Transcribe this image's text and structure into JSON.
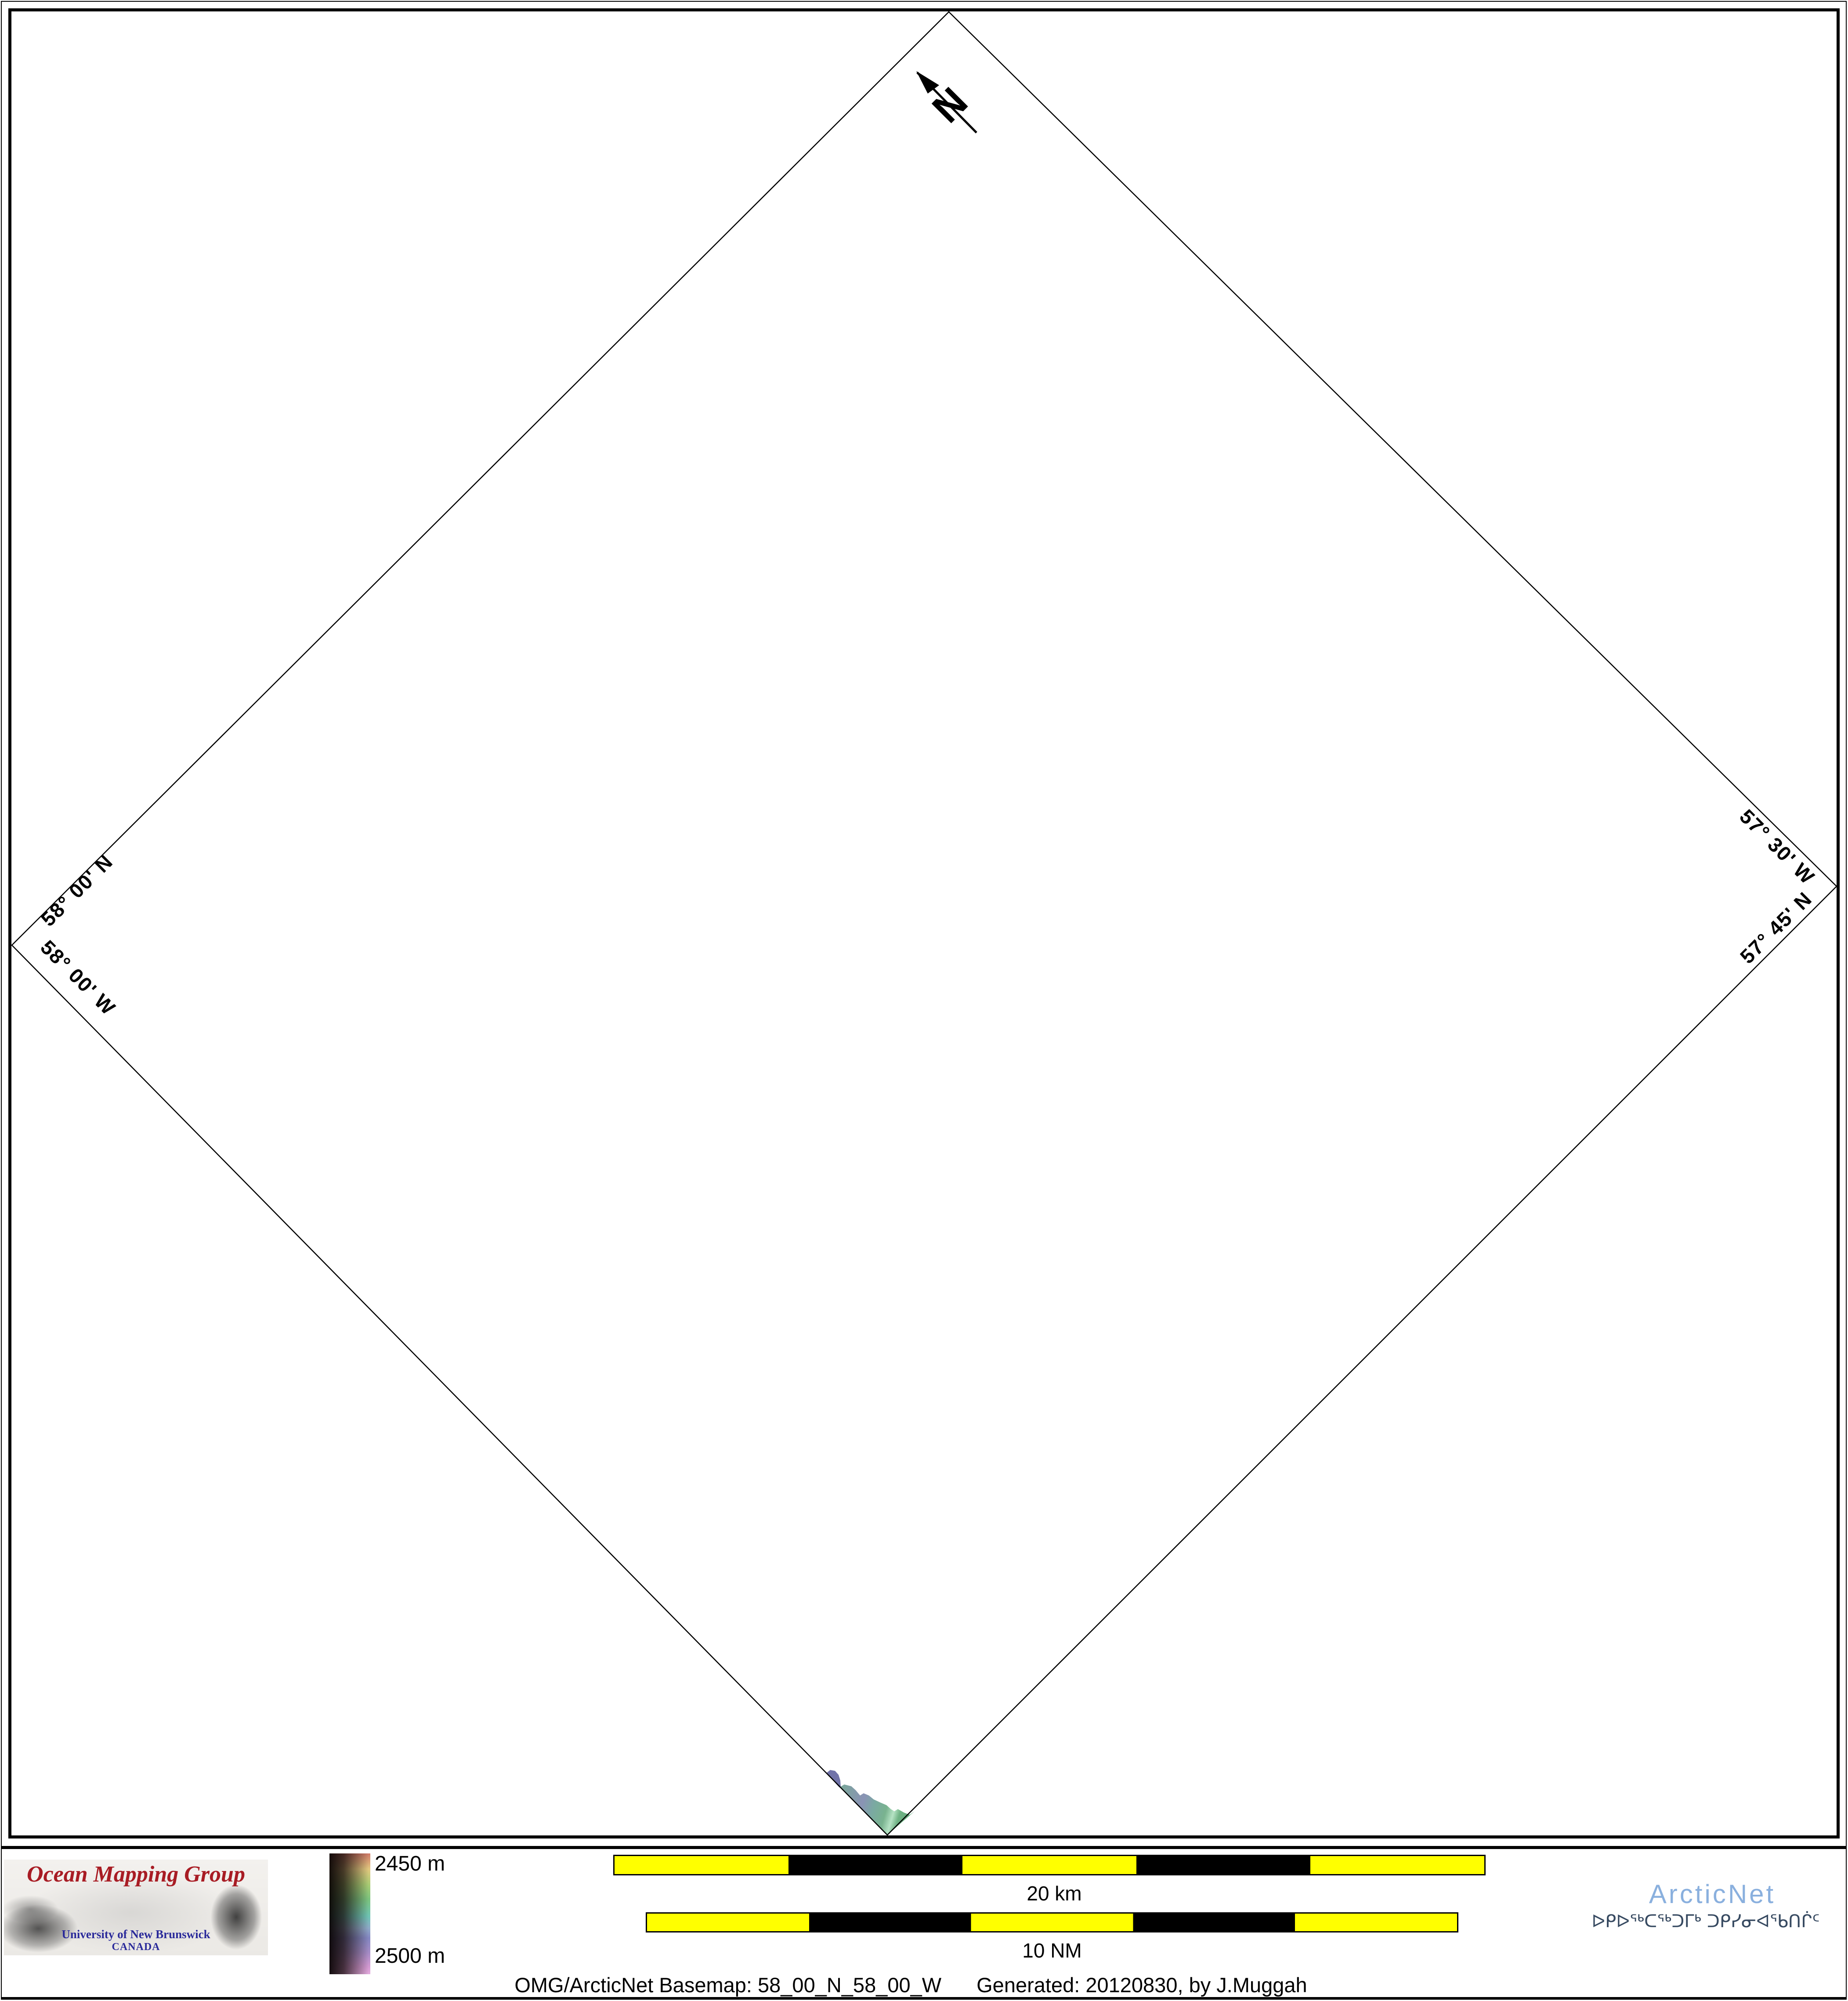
{
  "map": {
    "north_label": "N",
    "edge_labels": {
      "top_left": "58° 00' N",
      "bottom_left": "58° 00' W",
      "top_right": "57° 30' W",
      "bottom_right": "57° 45' N"
    }
  },
  "legend": {
    "omg_logo": {
      "title": "Ocean Mapping Group",
      "subtitle": "University of New Brunswick",
      "country": "CANADA"
    },
    "colorbar": {
      "top_label": "2450 m",
      "bottom_label": "2500 m"
    },
    "scalebars": [
      {
        "label": "20 km"
      },
      {
        "label": "10 NM"
      }
    ],
    "arcticnet": {
      "name": "ArcticNet",
      "inuktitut": "ᐅᑭᐅᖅᑕᖅᑐᒥᒃ ᑐᑭᓯᓂᐊᖃᑎᒌᑦ"
    },
    "caption": {
      "left": "OMG/ArcticNet Basemap: 58_00_N_58_00_W",
      "right": "Generated: 20120830, by J.Muggah"
    }
  },
  "colors": {
    "scalebar_yellow": "#ffff00",
    "omg_title_red": "#a81c24",
    "unb_blue": "#2a2a9a",
    "arcticnet_blue": "#8ab0de",
    "syllabics_navy": "#374a61",
    "patch_teal": "#7ba69b",
    "patch_blue": "#8a93b5",
    "patch_green": "#6fb284",
    "patch_purple": "#7173a9"
  }
}
